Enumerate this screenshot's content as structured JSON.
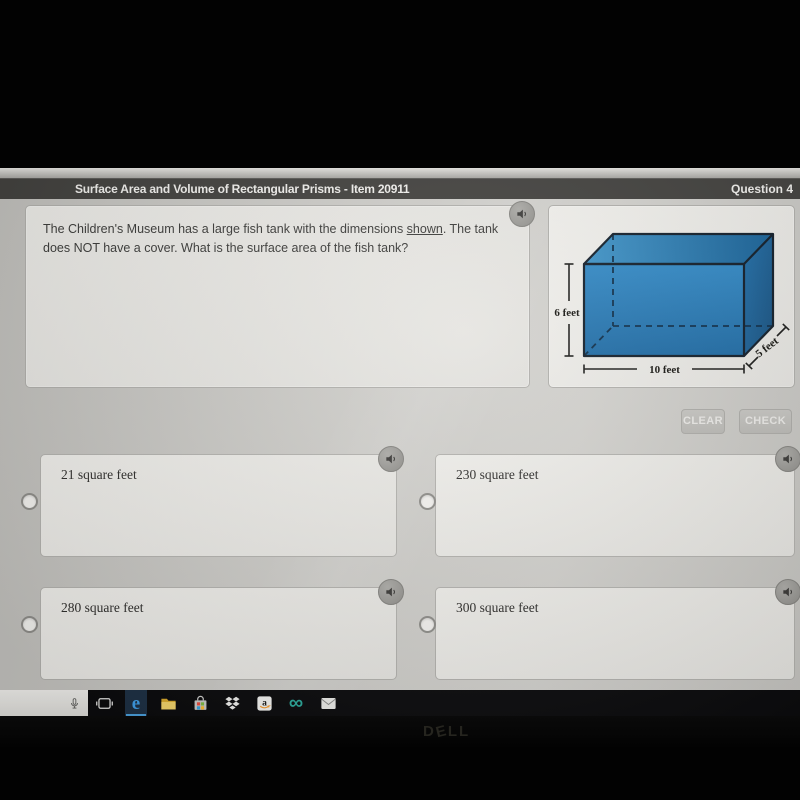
{
  "header": {
    "title": "Surface Area and Volume of Rectangular Prisms - Item 20911",
    "question_label": "Question 4"
  },
  "question": {
    "text_before_link": "The Children's Museum has a large fish tank with the dimensions ",
    "link_text": "shown",
    "text_after_link": ". The tank does NOT have a cover. What is the surface area of the fish tank?"
  },
  "diagram": {
    "shape": "rectangular-prism-fish-tank",
    "height_label": "6 feet",
    "length_label": "10 feet",
    "depth_label": "5 feet",
    "tank_color": "#2e86c4"
  },
  "actions": {
    "clear_label": "CLEAR",
    "check_label": "CHECK"
  },
  "answers": [
    {
      "label": "21 square feet"
    },
    {
      "label": "230 square feet"
    },
    {
      "label": "280 square feet"
    },
    {
      "label": "300 square feet"
    }
  ],
  "taskbar": {
    "icons": [
      "microphone-icon",
      "task-view-icon",
      "edge-icon",
      "file-explorer-icon",
      "microsoft-store-icon",
      "dropbox-icon",
      "amazon-icon",
      "infinity-icon",
      "mail-icon"
    ],
    "store_tile_colors": [
      "#e84b3c",
      "#7fbb42",
      "#35a1dc",
      "#fdb92e"
    ],
    "edge_blue": "#3f9ee8",
    "infinity_symbol": "∞"
  },
  "monitor": {
    "letters": [
      "D",
      "E",
      "L",
      "L"
    ]
  },
  "colors": {
    "header_bg": "#403f3c",
    "page_bg": "#c9c8c4"
  }
}
